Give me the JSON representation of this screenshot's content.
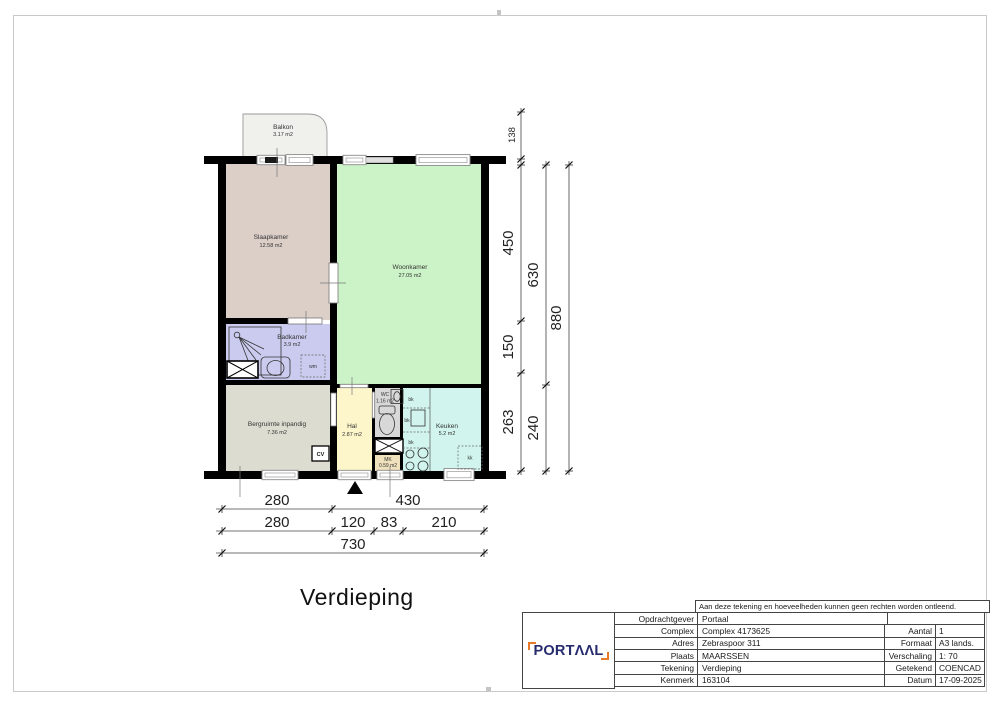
{
  "drawing_title": "Verdieping",
  "plan": {
    "rooms": {
      "balkon": {
        "name": "Balkon",
        "area": "3.17 m2"
      },
      "slaapkamer": {
        "name": "Slaapkamer",
        "area": "12.58 m2"
      },
      "woonkamer": {
        "name": "Woonkamer",
        "area": "27.05 m2"
      },
      "badkamer": {
        "name": "Badkamer",
        "area": "3.9 m2"
      },
      "bergruimte": {
        "name": "Bergruimte inpandig",
        "area": "7.36 m2"
      },
      "hal": {
        "name": "Hal",
        "area": "2.87 m2"
      },
      "wc": {
        "name": "WC",
        "area": "1.16 m2"
      },
      "mk": {
        "name": "MK",
        "area": "0.59 m2"
      },
      "keuken": {
        "name": "Keuken",
        "area": "5.2 m2"
      }
    },
    "annotations": {
      "wm": "wm",
      "cv": "CV",
      "bk1": "bk",
      "bk2": "bk",
      "bk3": "bk",
      "kk": "kk"
    },
    "dims": {
      "right": {
        "d138": "138",
        "d450": "450",
        "d150": "150",
        "d263": "263",
        "d630": "630",
        "d240": "240",
        "d880": "880"
      },
      "bottom": {
        "d280a": "280",
        "d430": "430",
        "d280b": "280",
        "d120": "120",
        "d83": "83",
        "d210": "210",
        "d730": "730"
      }
    },
    "colors": {
      "wall": "#000000",
      "balkon": "#f0f0ed",
      "slaapkamer": "#dccfc8",
      "woonkamer": "#ccf3c7",
      "badkamer": "#cbcbef",
      "bergruimte": "#dddcd0",
      "hal": "#fdf6ca",
      "wc": "#d8d8d8",
      "mk": "#efe1bc",
      "keuken": "#d1f5ee"
    }
  },
  "title_block": {
    "disclaimer": "Aan deze tekening en hoeveelheden kunnen geen rechten worden ontleend.",
    "logo_text": "PORTΛΛL",
    "rows_left": [
      {
        "label": "Opdrachtgever",
        "value": "Portaal"
      },
      {
        "label": "Complex",
        "value": "Complex 4173625"
      },
      {
        "label": "Adres",
        "value": "Zebraspoor 311"
      },
      {
        "label": "Plaats",
        "value": "MAARSSEN"
      },
      {
        "label": "Tekening",
        "value": "Verdieping"
      },
      {
        "label": "Kenmerk",
        "value": "163104"
      }
    ],
    "rows_right": [
      {
        "label": "Aantal",
        "value": "1"
      },
      {
        "label": "Formaat",
        "value": "A3  lands."
      },
      {
        "label": "Verschaling",
        "value": "1: 70"
      },
      {
        "label": "Getekend",
        "value": "COENCAD"
      },
      {
        "label": "Datum",
        "value": "17-09-2025"
      }
    ],
    "colors": {
      "logo_navy": "#262b6e",
      "logo_orange": "#e87a2b"
    }
  }
}
